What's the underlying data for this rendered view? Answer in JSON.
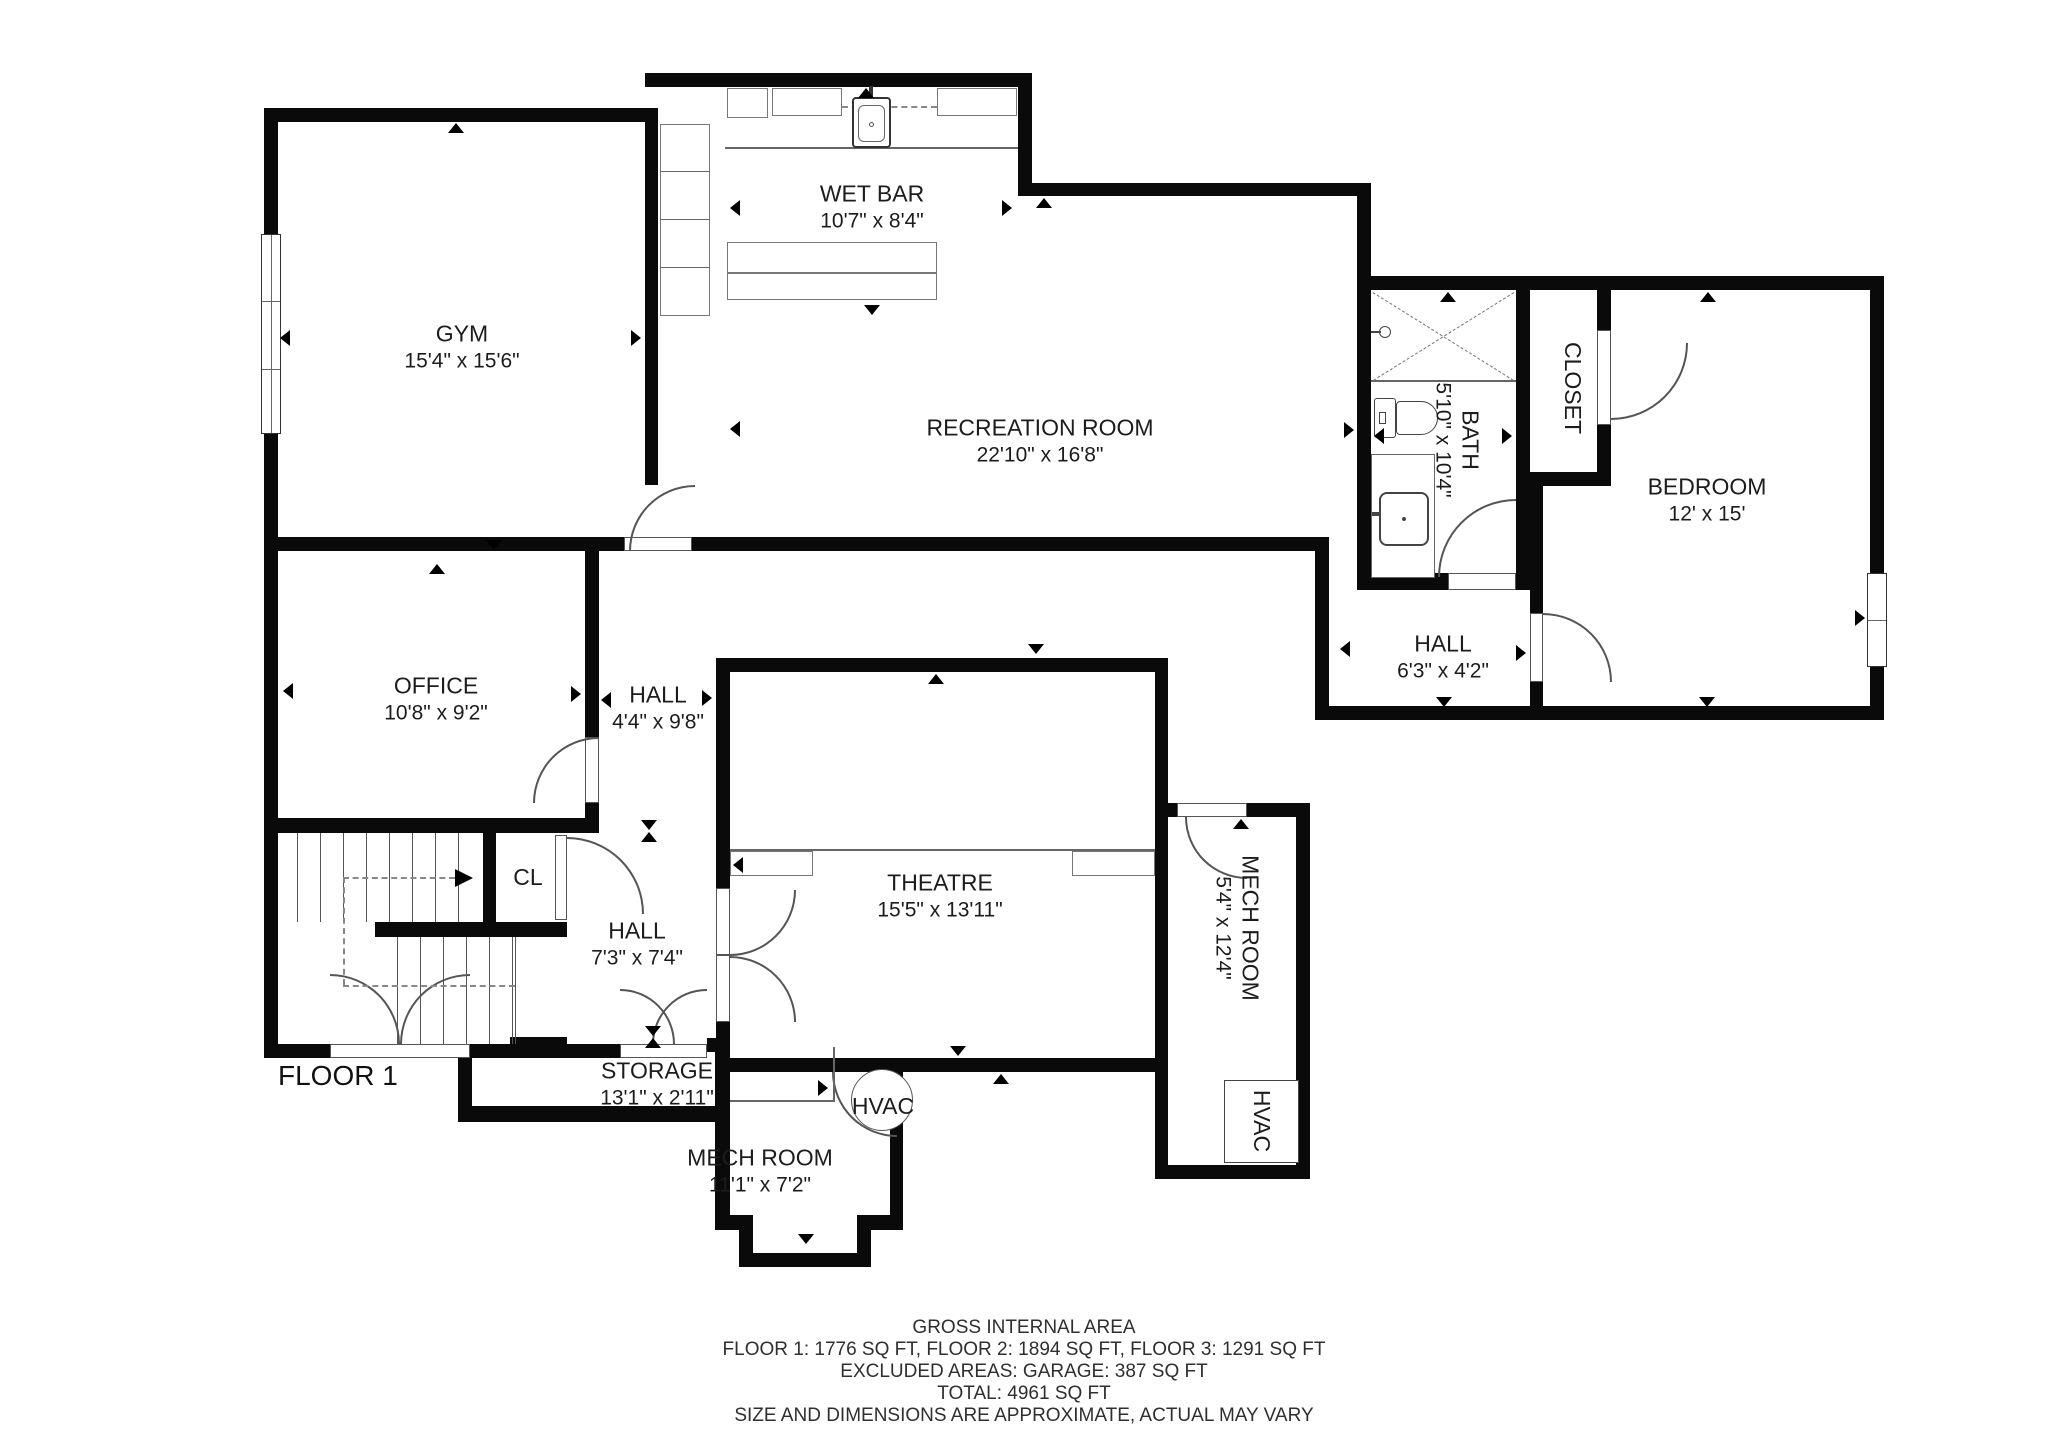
{
  "colors": {
    "wall": "#0a0a0a",
    "background": "#ffffff",
    "line": "#555555",
    "text": "#1c1c1c"
  },
  "floor_label": "FLOOR 1",
  "rooms": [
    {
      "name": "GYM",
      "dims": "15'4\" x 15'6\""
    },
    {
      "name": "WET BAR",
      "dims": "10'7\" x 8'4\""
    },
    {
      "name": "RECREATION ROOM",
      "dims": "22'10\" x 16'8\""
    },
    {
      "name": "BATH",
      "dims": "5'10\" x 10'4\""
    },
    {
      "name": "CLOSET",
      "dims": ""
    },
    {
      "name": "BEDROOM",
      "dims": "12' x 15'"
    },
    {
      "name": "OFFICE",
      "dims": "10'8\" x 9'2\""
    },
    {
      "name": "HALL",
      "dims": "4'4\" x 9'8\""
    },
    {
      "name": "CL",
      "dims": ""
    },
    {
      "name": "HALL",
      "dims": "7'3\" x 7'4\""
    },
    {
      "name": "THEATRE",
      "dims": "15'5\" x 13'11\""
    },
    {
      "name": "MECH ROOM",
      "dims": "5'4\" x 12'4\""
    },
    {
      "name": "STORAGE",
      "dims": "13'1\" x 2'11\""
    },
    {
      "name": "HVAC",
      "dims": ""
    },
    {
      "name": "HVAC",
      "dims": ""
    },
    {
      "name": "MECH ROOM",
      "dims": "11'1\" x 7'2\""
    },
    {
      "name": "HALL",
      "dims": "6'3\" x 4'2\""
    }
  ],
  "footer": {
    "lines": [
      "GROSS INTERNAL AREA",
      "FLOOR 1: 1776 SQ FT, FLOOR 2: 1894 SQ FT, FLOOR 3: 1291 SQ FT",
      "EXCLUDED AREAS: GARAGE: 387 SQ FT",
      "TOTAL: 4961 SQ FT",
      "SIZE AND DIMENSIONS ARE APPROXIMATE, ACTUAL MAY VARY"
    ]
  }
}
